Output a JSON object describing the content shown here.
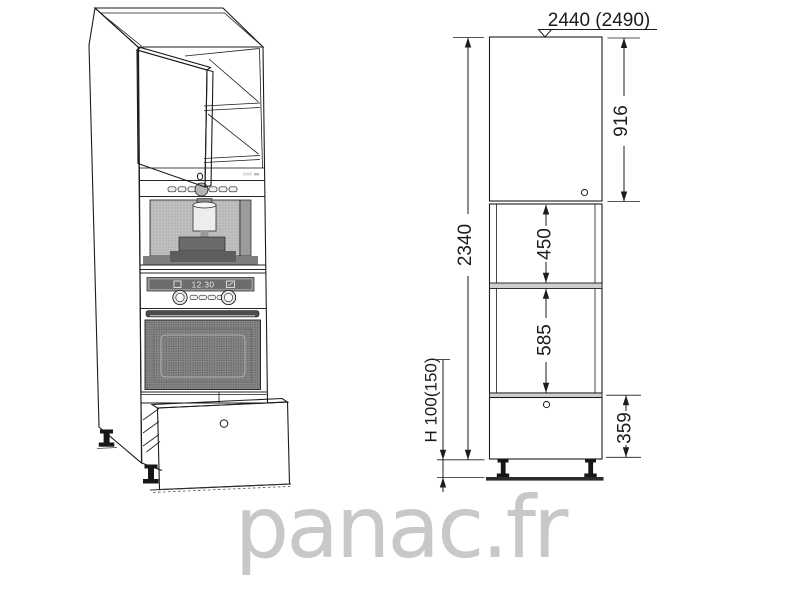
{
  "watermark": {
    "text": "panac.fr",
    "color": "#c8c8c8"
  },
  "perspective": {
    "description": "tall-oven-coffee-column-cabinet-3d-view",
    "oven_display_time": "12.30"
  },
  "dimensions": {
    "ceiling_height": "2440 (2490)",
    "cabinet_height": "2340",
    "top_door_height": "916",
    "upper_opening_height": "450",
    "lower_opening_height": "585",
    "drawer_front_height": "359",
    "plinth_height": "H 100(150)"
  },
  "colors": {
    "line": "#1c1c1c",
    "halftone_light": "#c0c0c0",
    "halftone_mid": "#a9a9a9",
    "halftone_dark": "#8e8e8e",
    "watermark": "#c8c8c8"
  }
}
